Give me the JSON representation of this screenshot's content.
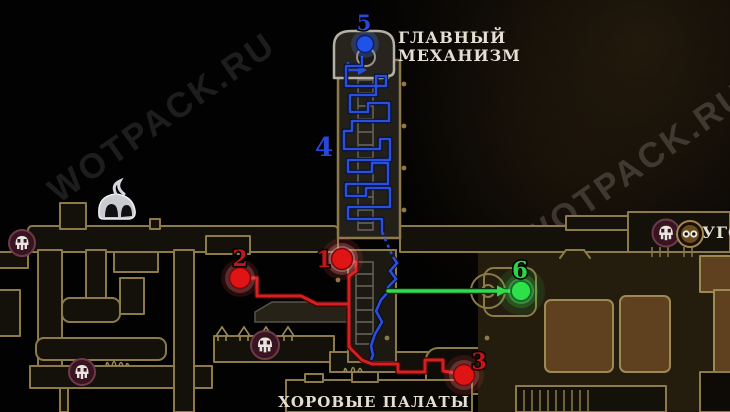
{
  "page": {
    "type": "game-map-guide-screenshot"
  },
  "watermark": {
    "text": "WOTPACK.RU"
  },
  "areas": {
    "main_mechanism": {
      "line1": "ГЛАВНЫЙ",
      "line2": "МЕХАНИЗМ"
    },
    "choral_chambers": "ХОРОВЫЕ ПАЛАТЫ",
    "right_edge_partial": "УГО"
  },
  "markers": {
    "m1": {
      "num": "1",
      "color": "#e01414"
    },
    "m2": {
      "num": "2",
      "color": "#e01414"
    },
    "m3": {
      "num": "3",
      "color": "#e01414"
    },
    "m4": {
      "num": "4",
      "color": "#2947d8"
    },
    "m5": {
      "num": "5",
      "color": "#1e52e8"
    },
    "m6": {
      "num": "6",
      "color": "#2ee04a"
    }
  },
  "routes": {
    "red": {
      "color": "#d81f1f"
    },
    "blue": {
      "color": "#2b4fd8"
    },
    "green": {
      "color": "#35d94f"
    }
  },
  "icons": {
    "bell": "bell-station-icon",
    "mask": "mask-icon",
    "cog": "cog-face-icon"
  },
  "colors": {
    "map_outline": "#8c7a4a",
    "room_brown": "#5f4120",
    "background": "#000000"
  }
}
